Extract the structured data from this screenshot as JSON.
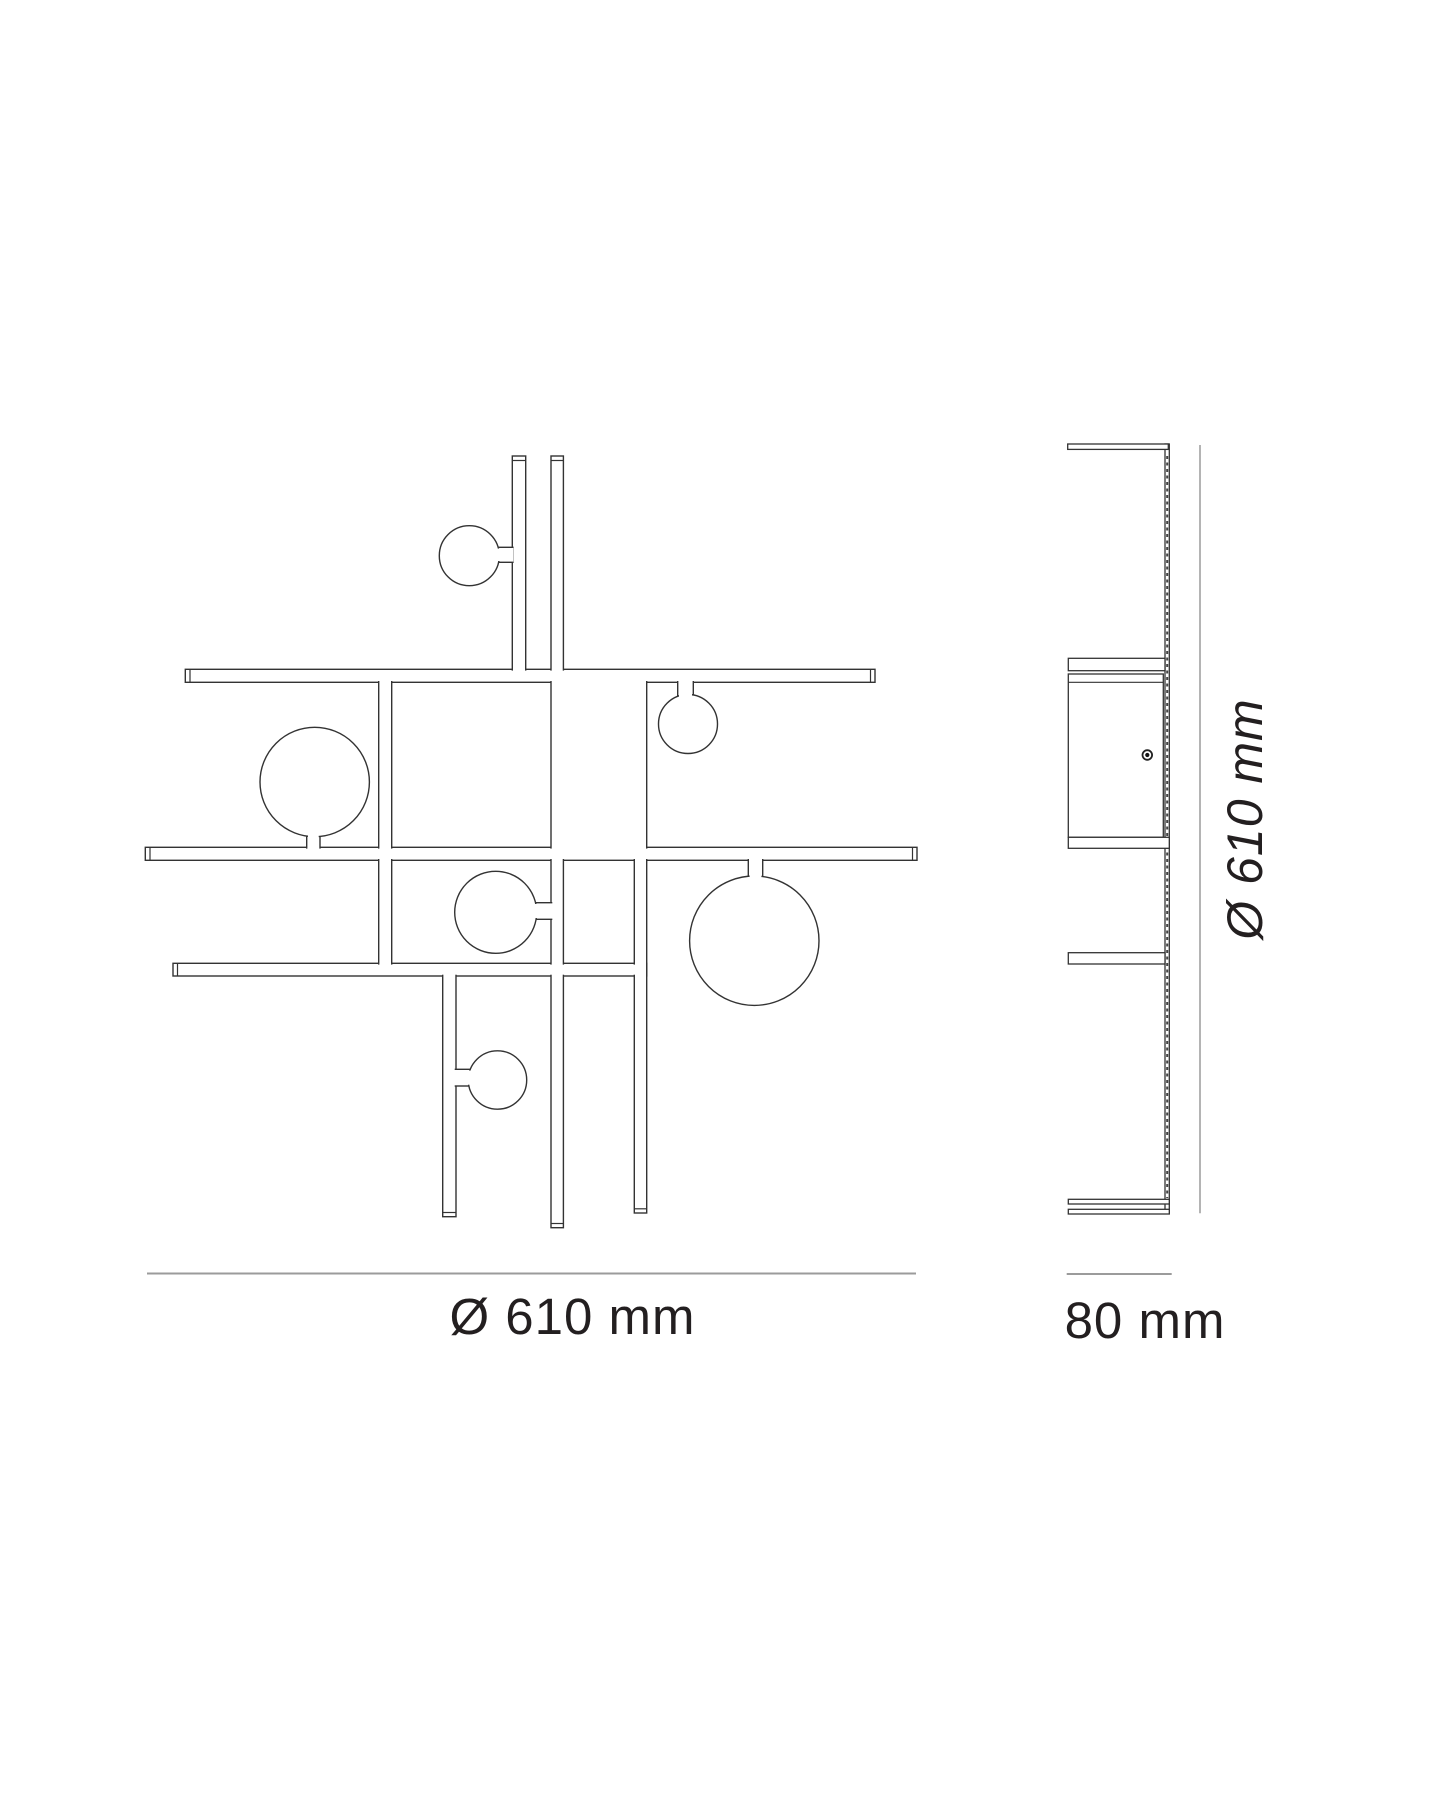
{
  "document": {
    "type": "product-dimension-drawing",
    "views": {
      "front_view": "wall lamp front elevation",
      "side_view": "wall lamp side profile"
    }
  },
  "dimensions": {
    "front_diameter": {
      "label": "Ø 610 mm"
    },
    "side_height": {
      "label": "Ø 610 mm"
    },
    "side_depth": {
      "label": "80 mm"
    }
  },
  "colors": {
    "outline": "#333333",
    "dimension_line": "#9b9b9b",
    "label_text": "#231f20",
    "background": "#ffffff"
  }
}
